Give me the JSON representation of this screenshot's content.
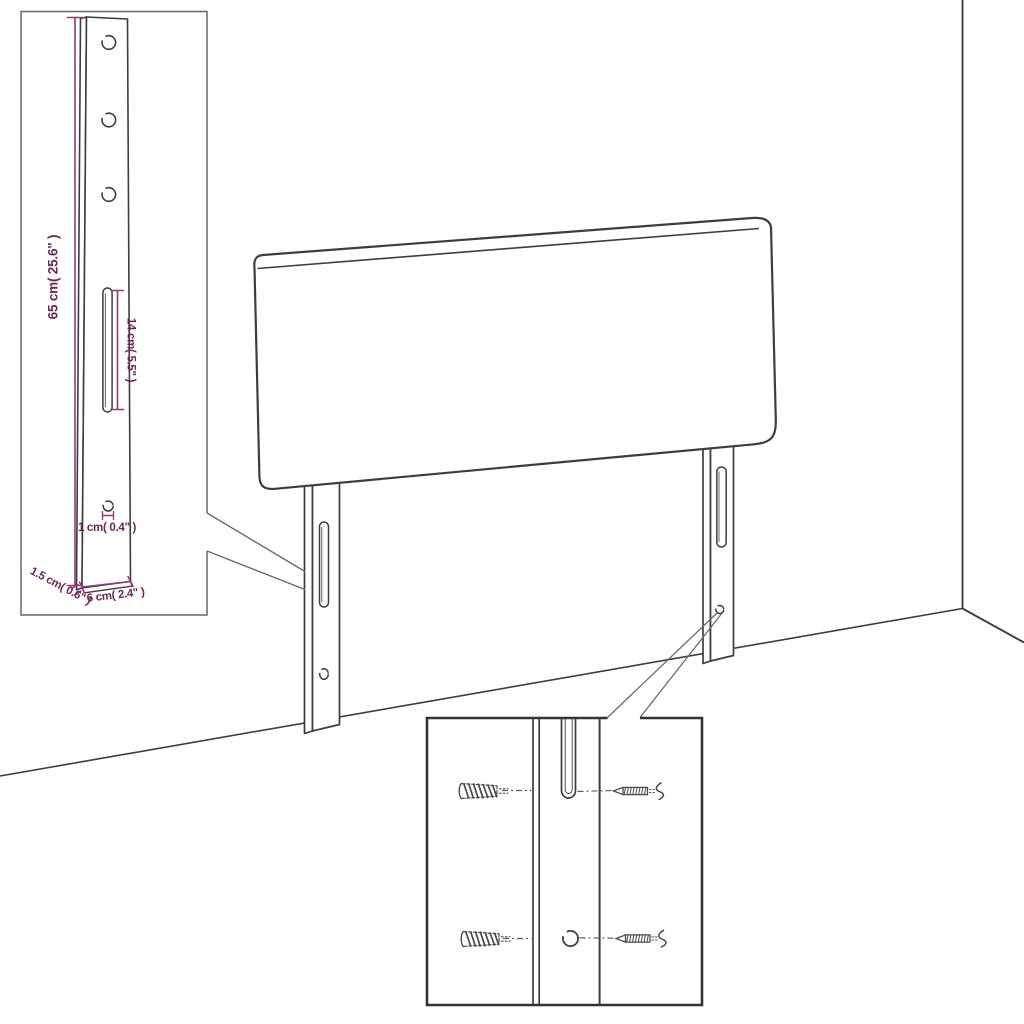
{
  "diagram": {
    "description": "headboard-assembly-dimension-diagram",
    "bracket_inset": {
      "labels": {
        "height": "65 cm( 25.6\" )",
        "slot_length": "14 cm( 5.5\" )",
        "hole_diameter": "1 cm( 0.4\" )",
        "thickness": "1.5 cm( 0.6\" )",
        "width": "6 cm( 2.4\" )"
      }
    },
    "colors": {
      "dimension_text": "#6d2558",
      "dimension_line": "#933a7c",
      "sketch_line": "#3d3d3d",
      "inset_border": "#666666",
      "background": "#ffffff"
    }
  }
}
